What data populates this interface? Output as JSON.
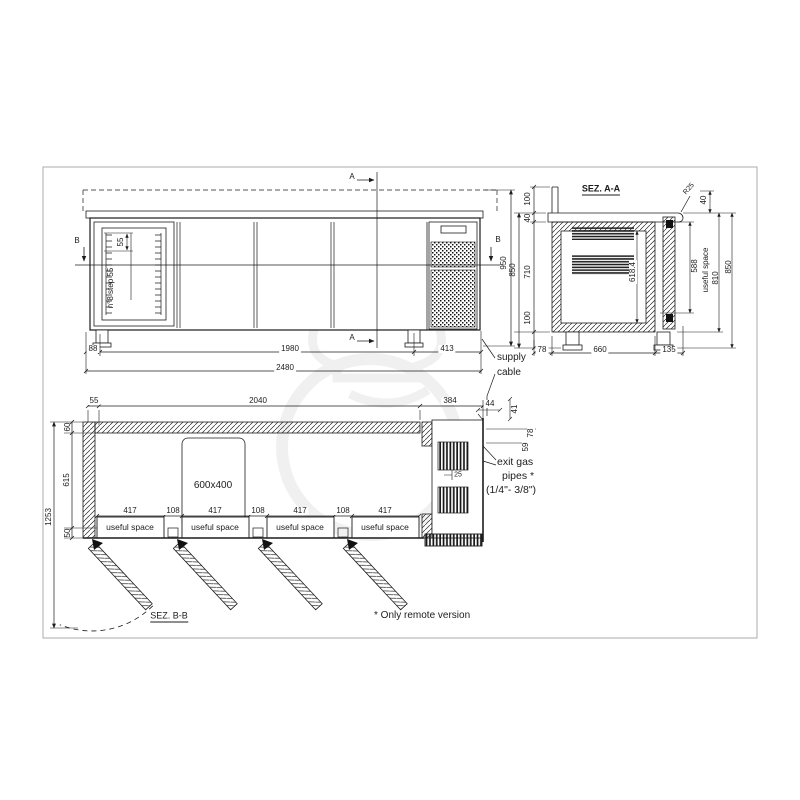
{
  "drawing": {
    "footnote": "* Only remote version"
  },
  "front_view": {
    "cut_a": "A",
    "cut_b": "B",
    "height": "950",
    "shelf_pitch": "55",
    "shelf_note": "n°8 step 55",
    "dim_left": "88",
    "dim_body": "1980",
    "dim_unit": "413",
    "dim_total": "2480",
    "supply_line1": "supply",
    "supply_line2": "cable"
  },
  "section_aa": {
    "title": "SEZ. A-A",
    "dim_upstand": "100",
    "dim_worktop": "40",
    "dim_body": "710",
    "dim_legs": "100",
    "dim_overall_left": "850",
    "dim_top_right": "40",
    "dim_radius": "R25",
    "dim_useful": "588",
    "useful_label": "useful space",
    "dim_door": "810",
    "dim_overall_right": "850",
    "dim_interior": "618.4",
    "dim_rear": "78",
    "dim_mid": "660",
    "dim_front": "135"
  },
  "plan_view": {
    "dim_left_edge": "55",
    "dim_body": "2040",
    "dim_unit": "384",
    "dim_pipe_h": "44",
    "dim_pipe_v": "41",
    "dim_pipe_c": "78",
    "dim_pipe_d": "59",
    "dim_back": "60",
    "dim_depth": "615",
    "dim_front": "50",
    "dim_overall": "1253",
    "tray_label": "600x400",
    "dim_vent": "25",
    "openings": [
      {
        "width": "417",
        "label": "useful space"
      },
      {
        "width": "417",
        "label": "useful space"
      },
      {
        "width": "417",
        "label": "useful space"
      },
      {
        "width": "417",
        "label": "useful space"
      }
    ],
    "gaps": [
      "108",
      "108",
      "108"
    ],
    "exit_line1": "exit gas",
    "exit_line2": "pipes *",
    "exit_line3": "(1/4\"- 3/8\")",
    "section_label": "SEZ. B-B"
  }
}
